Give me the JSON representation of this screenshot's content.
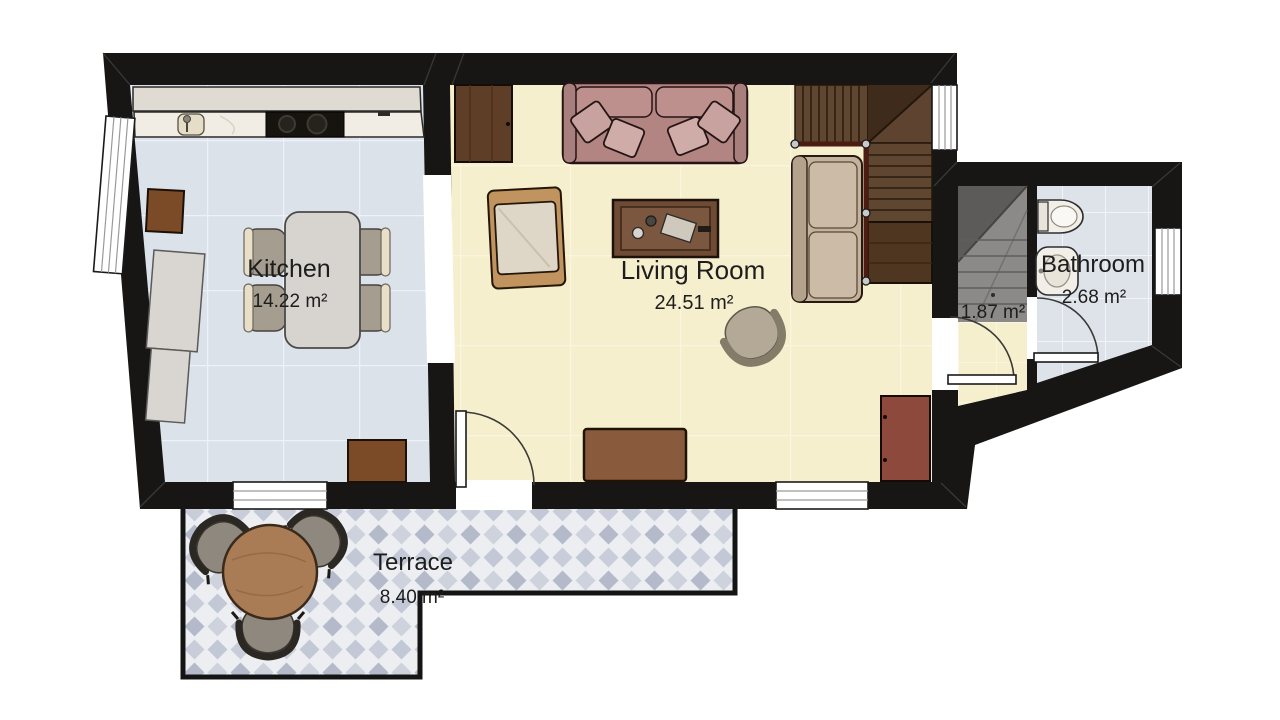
{
  "page": {
    "background": "#ffffff",
    "type_note": "2D architectural floor plan, top view"
  },
  "rooms": {
    "kitchen": {
      "label": "Kitchen",
      "area": "14.22 m²"
    },
    "living_room": {
      "label": "Living Room",
      "area": "24.51 m²"
    },
    "bathroom": {
      "label": "Bathroom",
      "area": "2.68 m²"
    },
    "stair_hall": {
      "area": "1.87 m²"
    },
    "terrace": {
      "label": "Terrace",
      "area": "8.40 m²"
    }
  },
  "colors": {
    "wall": "#181614",
    "kitchen_floor": "#dbe2ea",
    "living_floor": "#f6efcd",
    "bathroom_floor": "#dde3e9",
    "hall_stair_concrete": "#8b8a88",
    "terrace_tile": "#c8cdd9",
    "stair_wood": "#5e4330",
    "handrail": "#4c1c12",
    "sofa": "#b28583",
    "sectional": "#c3b29e",
    "wood_furniture": "#8a5a3c",
    "text": "#1d1d1d"
  }
}
